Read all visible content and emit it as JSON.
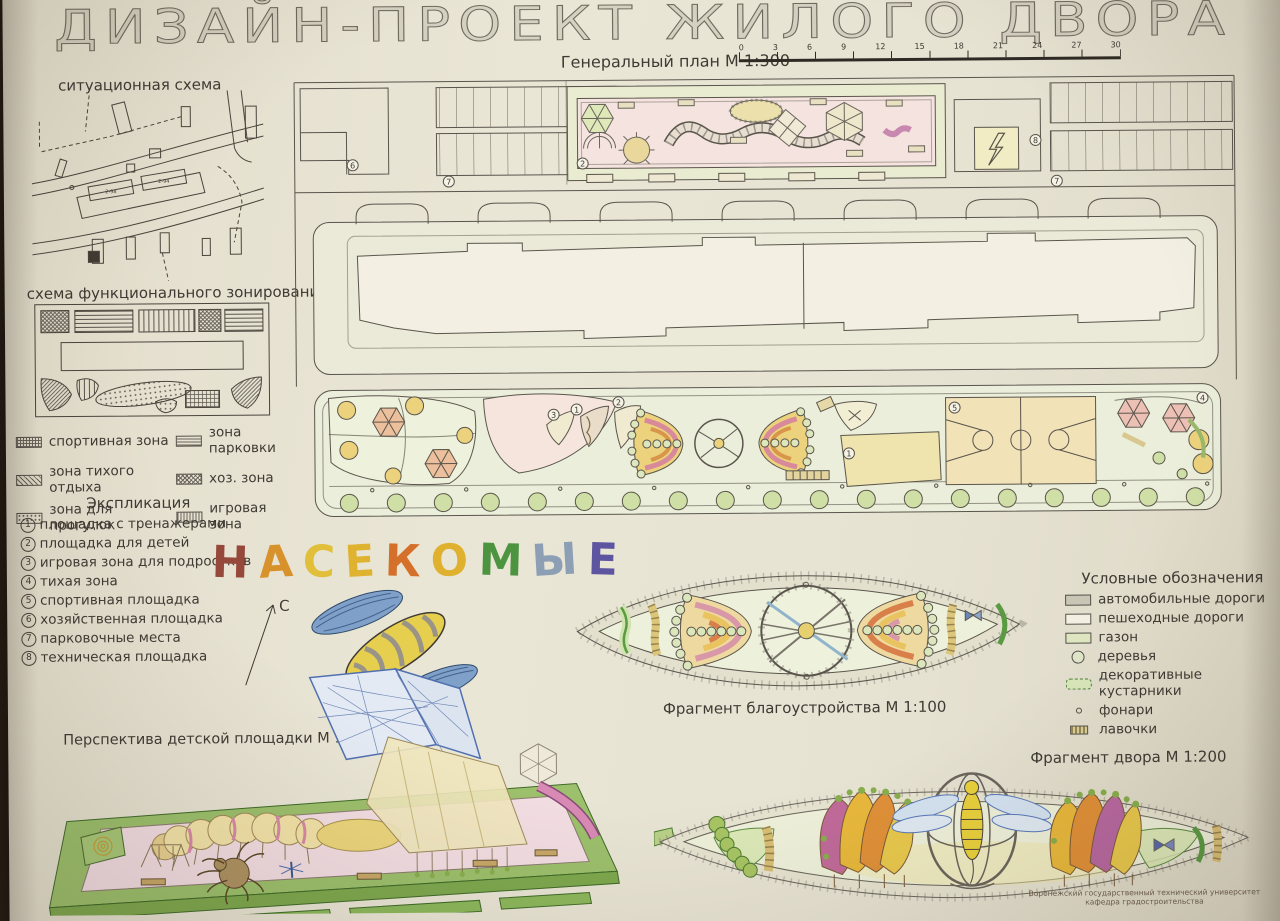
{
  "title": "ДИЗАЙН-ПРОЕКТ ЖИЛОГО ДВОРА",
  "situational": {
    "label": "ситуационная схема",
    "building_labels": [
      "2-98",
      "2-94"
    ]
  },
  "zoning": {
    "label": "схема функционального зонирования",
    "legend": [
      {
        "label": "спортивная зона",
        "pattern": "sw-grid"
      },
      {
        "label": "зона парковки",
        "pattern": "sw-hlines"
      },
      {
        "label": "зона тихого отдыха",
        "pattern": "sw-diag"
      },
      {
        "label": "хоз. зона",
        "pattern": "sw-cross"
      },
      {
        "label": "зона для прогулок",
        "pattern": "sw-dots"
      },
      {
        "label": "игровая зона",
        "pattern": "sw-vlines"
      }
    ]
  },
  "explication": {
    "title": "Экспликация",
    "items": [
      {
        "num": "1",
        "label": "площадка с тренажерами"
      },
      {
        "num": "2",
        "label": "площадка для детей"
      },
      {
        "num": "3",
        "label": "игровая зона для подростков"
      },
      {
        "num": "4",
        "label": "тихая зона"
      },
      {
        "num": "5",
        "label": "спортивная площадка"
      },
      {
        "num": "6",
        "label": "хозяйственная площадка"
      },
      {
        "num": "7",
        "label": "парковочные места"
      },
      {
        "num": "8",
        "label": "техническая площадка"
      }
    ]
  },
  "theme": {
    "word_letters": [
      {
        "ch": "Н",
        "color": "#96483a"
      },
      {
        "ch": "А",
        "color": "#d8922c"
      },
      {
        "ch": "С",
        "color": "#e2bf3a"
      },
      {
        "ch": "Е",
        "color": "#dfb22f"
      },
      {
        "ch": "К",
        "color": "#d4702a"
      },
      {
        "ch": "О",
        "color": "#e0b02f"
      },
      {
        "ch": "М",
        "color": "#4d9440"
      },
      {
        "ch": "Ы",
        "color": "#8d9fb5"
      },
      {
        "ch": "Е",
        "color": "#5d55a0"
      }
    ],
    "north": "С"
  },
  "general_plan": {
    "label": "Генеральный план М 1:300",
    "scale_ticks": [
      "0",
      "3",
      "6",
      "9",
      "12",
      "15",
      "18",
      "21",
      "24",
      "27",
      "30"
    ],
    "numbers": {
      "n1": "1",
      "n2": "2",
      "n3": "3",
      "n4": "4",
      "n5": "5",
      "n6": "6",
      "n7": "7",
      "n8": "8"
    }
  },
  "legend": {
    "title": "Условные обозначения",
    "items": [
      {
        "label": "автомобильные дороги",
        "swatch": "sw-road"
      },
      {
        "label": "пешеходные дороги",
        "swatch": "sw-path"
      },
      {
        "label": "газон",
        "swatch": "sw-lawn"
      },
      {
        "label": "деревья",
        "swatch": "sw-tree"
      },
      {
        "label": "декоративные кустарники",
        "swatch": "sw-shrub"
      },
      {
        "label": "фонари",
        "swatch": "sw-lamp"
      },
      {
        "label": "лавочки",
        "swatch": "sw-bench"
      }
    ]
  },
  "fragments": {
    "improvement_label": "Фрагмент благоустройства М 1:100",
    "courtyard_label": "Фрагмент двора М 1:200",
    "perspective_label": "Перспектива детской площадки М 1:200"
  },
  "footer": {
    "line1": "Воронежский государственный технический университет",
    "line2": "кафедра градостроительства"
  }
}
